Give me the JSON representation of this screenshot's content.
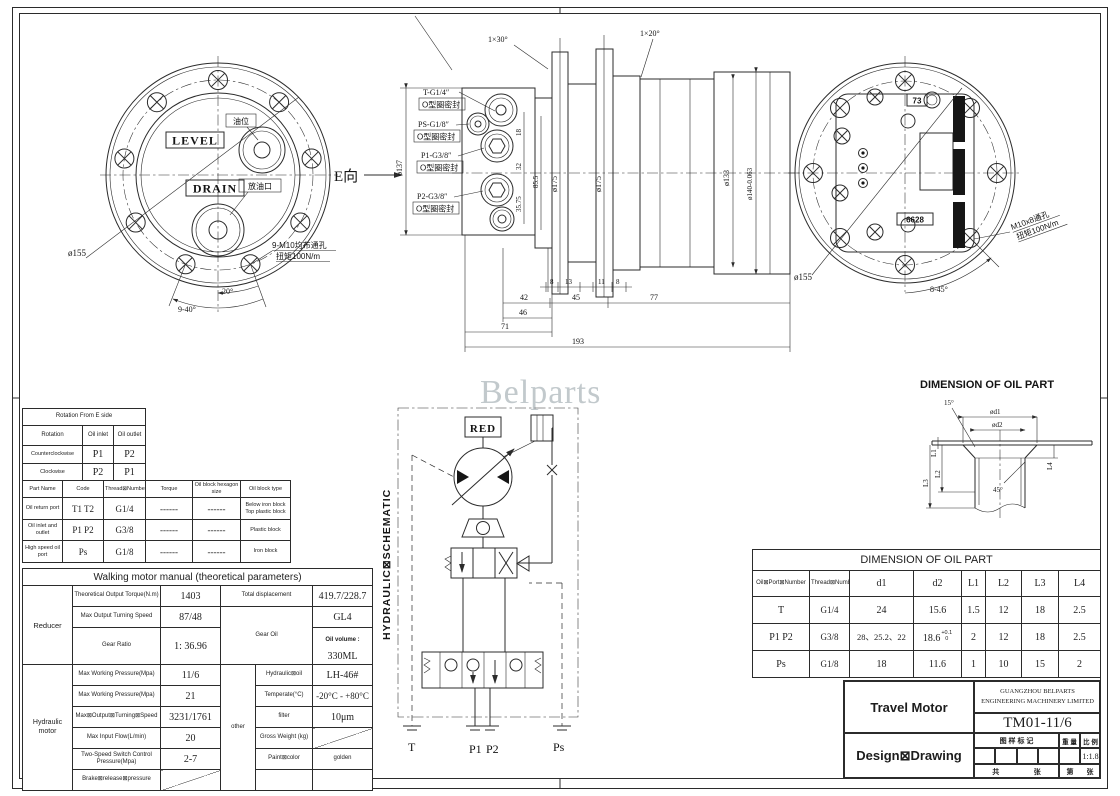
{
  "watermark": "Belparts",
  "front_view": {
    "level": "LEVEL",
    "drain": "DRAIN",
    "oil_level": "油位",
    "drain_port": "放油口",
    "dia": "ø155",
    "view_dir": "E向",
    "note1": "9-M10均布通孔",
    "note2": "扭矩100N/m",
    "angle20": "20°",
    "angle940": "9-40°"
  },
  "section_view": {
    "chamfer_left": "1×30°",
    "chamfer_right": "1×20°",
    "ports": [
      {
        "label": "T-G1/4″",
        "seal": "O型圈密封"
      },
      {
        "label": "PS-G1/8″",
        "seal": "O型圈密封"
      },
      {
        "label": "P1-G3/8″",
        "seal": "O型圈密封"
      },
      {
        "label": "P2-G3/8″",
        "seal": "O型圈密封"
      }
    ],
    "dia_137": "ø137",
    "dim_18": "18",
    "dim_32": "32",
    "dim_3575": "35.75",
    "dim_855": "85.5",
    "dia_175a": "ø175",
    "dia_175b": "ø175",
    "dia_133": "ø133",
    "dia_140": "ø140-0.063",
    "b8a": "8",
    "b13": "13",
    "b11": "11",
    "b8b": "8",
    "b42": "42",
    "b45": "45",
    "b77": "77",
    "b46": "46",
    "b71": "71",
    "b193": "193"
  },
  "rear_view": {
    "dia": "ø155",
    "plug_top": "73",
    "plug_bottom": "6628",
    "note1": "M10x8通孔",
    "note2": "扭矩100N/m",
    "angle": "8-45°"
  },
  "oil_detail": {
    "title": "DIMENSION OF OIL PART",
    "a15": "15°",
    "d1": "ød1",
    "d2": "ød2",
    "L1": "L1",
    "L2": "L2",
    "L3": "L3",
    "L4": "L4",
    "a45": "45°"
  },
  "schematic": {
    "title": "HYDRAULIC⊠SCHEMATIC",
    "red": "RED",
    "t": "T",
    "p1": "P1",
    "p2": "P2",
    "ps": "Ps"
  },
  "rotation_table": {
    "title": "Rotation From E side",
    "headers": [
      "Rotation",
      "Oil inlet",
      "Oil outlet"
    ],
    "rows": [
      [
        "Counterclockwise",
        "P1",
        "P2"
      ],
      [
        "Clockwise",
        "P2",
        "P1"
      ]
    ],
    "part_headers": [
      "Part Name",
      "Code",
      "Thread⊠Number",
      "Torque",
      "Oil block hexagon size",
      "Oil block type"
    ],
    "part_rows": [
      {
        "name": "Oil return port",
        "code": "T1  T2",
        "thread": "G1/4",
        "torque": "------",
        "hex": "------",
        "type1": "Below iron block",
        "type2": "Top plastic block"
      },
      {
        "name": "Oil inlet and outlet",
        "code": "P1  P2",
        "thread": "G3/8",
        "torque": "------",
        "hex": "------",
        "type1": "Plastic block",
        "type2": ""
      },
      {
        "name": "High speed oil port",
        "code": "Ps",
        "thread": "G1/8",
        "torque": "------",
        "hex": "------",
        "type1": "Iron block",
        "type2": ""
      }
    ]
  },
  "motor_table": {
    "title": "Walking motor manual (theoretical parameters)",
    "group1": "Reducer",
    "group2": "Hydraulic motor",
    "other": "other",
    "r1_label": "Theoretical Output Torque(N.m)",
    "r1_value": "1403",
    "r1_label2": "Total displacement",
    "r1_value2": "419.7/228.7",
    "r2_label": "Max Output Turning Speed",
    "r2_value": "87/48",
    "r2_label2": "Gear Oil",
    "r2_value2": "GL4",
    "r3_label": "Gear Ratio",
    "r3_value": "1: 36.96",
    "r3_label2": "Oil volume :",
    "r3_value2": "330ML",
    "h1_label": "Max Working Pressure(Mpa)",
    "h1_value": "11/6",
    "h1_label2": "Hydraulic⊠oil",
    "h1_value2": "LH-46#",
    "h2_label": "Max Working Pressure(Mpa)",
    "h2_value": "21",
    "h2_label2": "Temperate(°C)",
    "h2_value2": "-20°C - +80°C",
    "h3_label": "Max⊠Output⊠Turning⊠Speed",
    "h3_value": "3231/1761",
    "h3_label2": "filter",
    "h3_value2": "10μm",
    "h4_label": "Max Input Flow(L/min)",
    "h4_value": "20",
    "h4_label2": "Gross Weight (kg)",
    "h5_label": "Two-Speed Switch Control Pressure(Mpa)",
    "h5_value": "2-7",
    "h5_label2": "Paint⊠color",
    "h5_value2": "golden",
    "h6_label": "Brake⊠release⊠pressure"
  },
  "oil_part_table": {
    "title": "DIMENSION OF OIL PART",
    "headers": [
      "Oil⊠Port⊠Number",
      "Thread⊠Number",
      "d1",
      "d2",
      "L1",
      "L2",
      "L3",
      "L4"
    ],
    "rows": [
      [
        "T",
        "G1/4",
        "24",
        "15.6",
        "1.5",
        "12",
        "18",
        "2.5"
      ],
      [
        "P1  P2",
        "G3/8",
        "28、25.2、22",
        "18.6",
        "2",
        "12",
        "18",
        "2.5"
      ],
      [
        "Ps",
        "G1/8",
        "18",
        "11.6",
        "1",
        "10",
        "15",
        "2"
      ]
    ],
    "d2_tolerance": {
      "sup": "+0.1",
      "sub": "0"
    }
  },
  "title_block": {
    "part_name": "Travel Motor",
    "company_line1": "GUANGZHOU BELPARTS",
    "company_line2": "ENGINEERING MACHINERY LIMITED",
    "drawing_no": "TM01-11/6",
    "stage_label": "Design⊠Drawing",
    "mark_label": "图 样 标 记",
    "weight_label": "重 量",
    "scale_label": "比 例",
    "scale_value": "1:1.8",
    "total_label": "共",
    "sheet_label": "张",
    "page_label": "第",
    "page_sheet_label": "张"
  }
}
